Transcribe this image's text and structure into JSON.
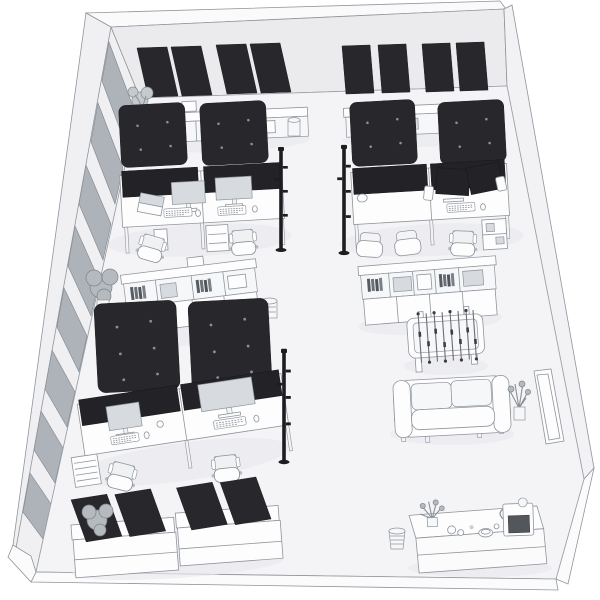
{
  "labels": {
    "title": "Isometric office 3D rendering",
    "scene": "Isometric line-art 3D rendering of an open-plan office",
    "room": "Office room shell with glazed left wall",
    "left_wall_windows": "Full-height window wall",
    "back_wall_panels": "Dark acoustic panels on back wall",
    "desk_pod_left": "Back-left desk pod with two workstations",
    "desk_pod_right": "Back-right desk pod with dual-monitor workstation",
    "desk_pod_front": "Front-left desk pod with two workstations",
    "ceiling_panels": "Suspended dark acoustic ceiling panels with downlights",
    "shelving_center": "Open shelving credenza with binders",
    "storage_right": "Two-tier storage sideboard",
    "foosball": "Foosball table",
    "sofa": "Two-seat sofa with plant",
    "whiteboard": "Whiteboard leaning on right wall",
    "front_cabinets": "Low cabinets with freestanding acoustic panels",
    "kitchenette": "Kitchenette sideboard with coffee machine",
    "floor_lamp": "Slim black floor lamp",
    "office_chair": "Swivel office chair",
    "plant": "Potted plant",
    "waste_bin": "Waste bin"
  },
  "colors": {
    "background": "#ffffff",
    "back_wall": "#ebebed",
    "left_wall": "#f0f0f2",
    "right_wall": "#f2f2f4",
    "wall_top_face": "#fafafb",
    "floor": "#f4f4f6",
    "floor_edge": "#fbfbfc",
    "window_glass": "#aeb3ba",
    "acoustic_panel_dark": "#28282c",
    "privacy_screen_dark": "#232327",
    "monitor_screen": "#d7dbdf",
    "outline": "#8f959c",
    "shadow": "#e9e9ee",
    "furniture_white": "#fdfdfe",
    "lamp_black": "#1d1d20"
  },
  "inventory": [
    {
      "item": "acoustic wall panel",
      "count": 8
    },
    {
      "item": "suspended acoustic ceiling panel",
      "count": 6
    },
    {
      "item": "desk workstation",
      "count": 6
    },
    {
      "item": "desktop privacy screen",
      "count": 6
    },
    {
      "item": "monitor",
      "count": 6
    },
    {
      "item": "laptop",
      "count": 1
    },
    {
      "item": "office chair",
      "count": 7
    },
    {
      "item": "storage credenza or shelving unit",
      "count": 4
    },
    {
      "item": "low cabinet with acoustic panels",
      "count": 2
    },
    {
      "item": "freestanding acoustic panel",
      "count": 4
    },
    {
      "item": "floor lamp",
      "count": 3
    },
    {
      "item": "potted plant",
      "count": 5
    },
    {
      "item": "waste bin",
      "count": 3
    },
    {
      "item": "foosball table",
      "count": 1
    },
    {
      "item": "sofa",
      "count": 1
    },
    {
      "item": "leaning whiteboard",
      "count": 1
    },
    {
      "item": "kitchenette sideboard",
      "count": 1
    },
    {
      "item": "coffee machine",
      "count": 1
    }
  ]
}
